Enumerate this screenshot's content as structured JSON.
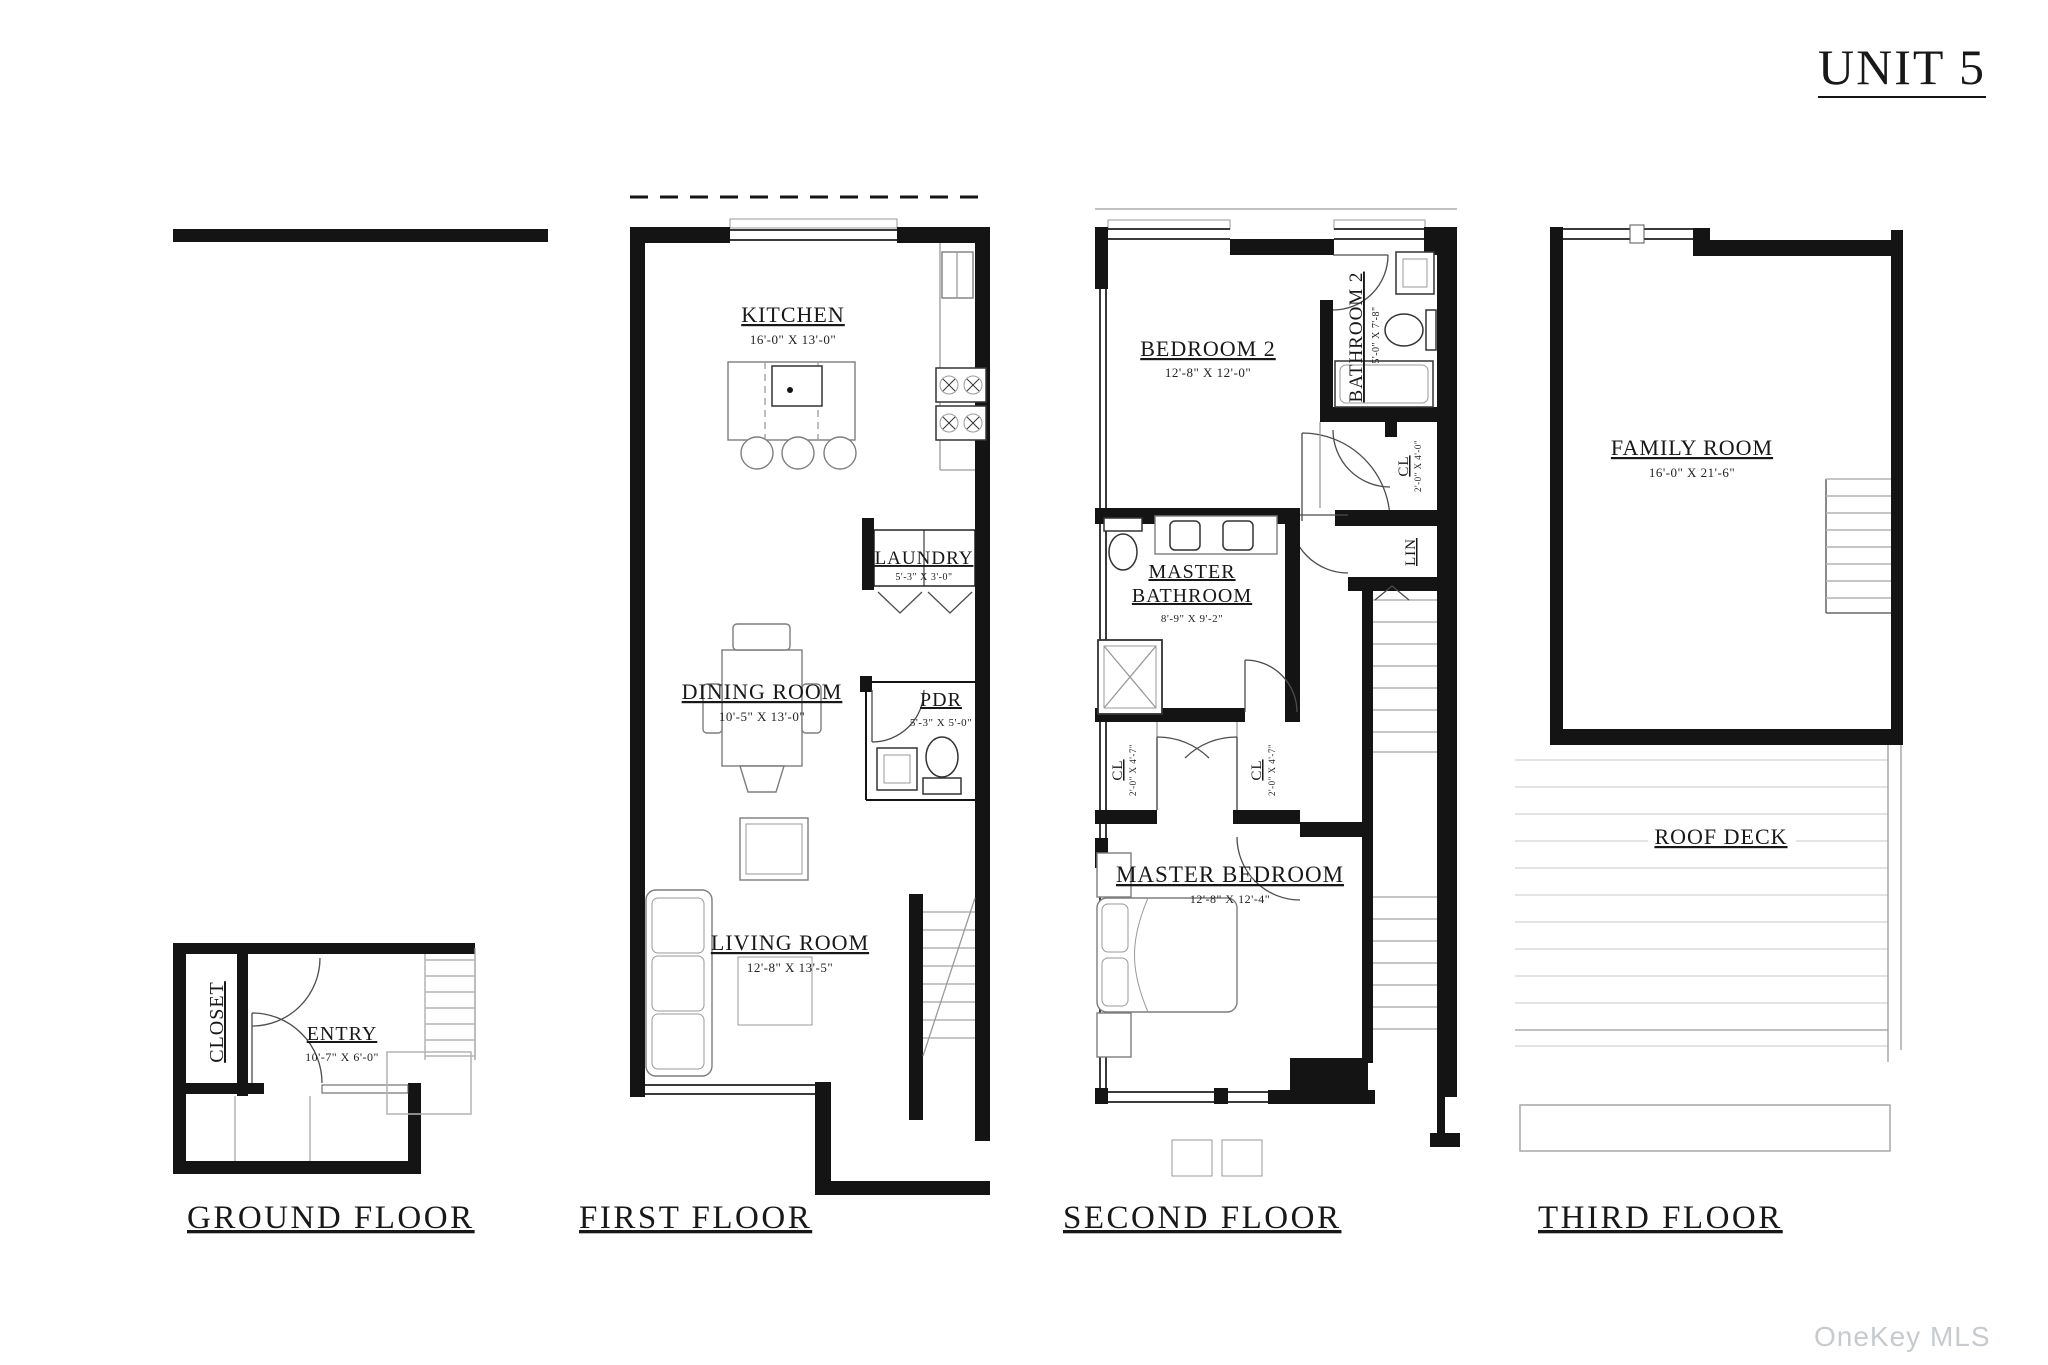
{
  "page": {
    "title": "UNIT 5",
    "watermark": "OneKey MLS"
  },
  "floors": [
    {
      "label": "GROUND FLOOR",
      "rooms": [
        {
          "name": "CLOSET"
        },
        {
          "name": "ENTRY",
          "dims": "10'-7\" X 6'-0\""
        }
      ]
    },
    {
      "label": "FIRST FLOOR",
      "rooms": [
        {
          "name": "KITCHEN",
          "dims": "16'-0\" X 13'-0\""
        },
        {
          "name": "LAUNDRY",
          "dims": "5'-3\" X 3'-0\""
        },
        {
          "name": "DINING ROOM",
          "dims": "10'-5\" X 13'-0\""
        },
        {
          "name": "PDR",
          "dims": "5'-3\" X 5'-0\""
        },
        {
          "name": "LIVING ROOM",
          "dims": "12'-8\" X 13'-5\""
        }
      ]
    },
    {
      "label": "SECOND FLOOR",
      "rooms": [
        {
          "name": "BEDROOM 2",
          "dims": "12'-8\" X 12'-0\""
        },
        {
          "name": "BATHROOM 2",
          "dims": "5'-0\" X 7'-8\""
        },
        {
          "name": "CL",
          "dims": "2'-0\" X 4'-0\""
        },
        {
          "name": "LIN"
        },
        {
          "name": "MASTER BATHROOM",
          "name_lines": [
            "MASTER",
            "BATHROOM"
          ],
          "dims": "8'-9\" X 9'-2\""
        },
        {
          "name": "CL",
          "dims": "2'-0\" X 4'-7\""
        },
        {
          "name": "CL",
          "dims": "2'-0\" X 4'-7\""
        },
        {
          "name": "MASTER BEDROOM",
          "dims": "12'-8\" X 12'-4\""
        }
      ]
    },
    {
      "label": "THIRD FLOOR",
      "rooms": [
        {
          "name": "FAMILY ROOM",
          "dims": "16'-0\" X 21'-6\""
        },
        {
          "name": "ROOF DECK"
        }
      ]
    }
  ]
}
